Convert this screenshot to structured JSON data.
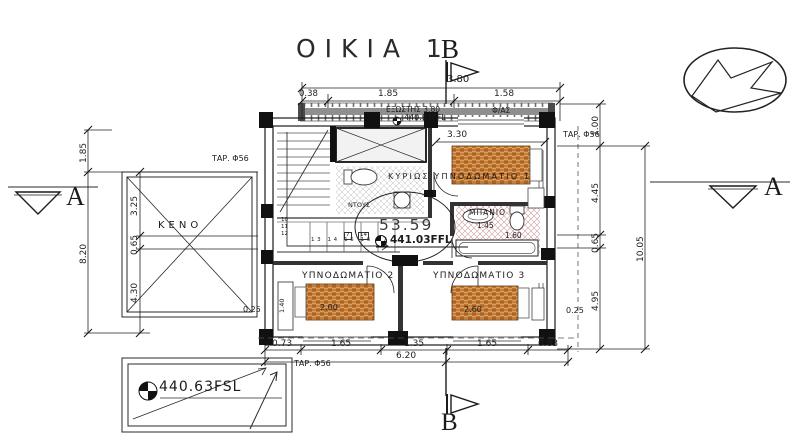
{
  "title": "ΟΙΚΙΑ 1",
  "sections": {
    "top": "B",
    "bottom": "B",
    "left": "A",
    "right": "A"
  },
  "icons": {
    "north": "north-arrow-icon",
    "level_marker": "level-marker-icon",
    "section_triangle": "section-arrow-icon"
  },
  "levels": {
    "floor_area": "53.59",
    "floor_level": "441.03FFL",
    "balcony_level": "440.93FFL",
    "ground_level": "440.63FSL"
  },
  "rooms": {
    "master_bedroom": "ΚΥΡΙΩΣ ΥΠΝΟΔΩΜΑΤΙΟ 1",
    "bedroom2": "ΥΠΝΟΔΩΜΑΤΙΟ 2",
    "bedroom3": "ΥΠΝΟΔΩΜΑΤΙΟ 3",
    "bathroom": "ΜΠΑΝΙΟ",
    "shower": "ΝΤΟΥΣ",
    "void": "ΚΕΝΟ",
    "balcony": "ΕΞΩΣΤΗΣ 3.80",
    "balcony_note": "Φ/ΑΣ"
  },
  "drainpipes": {
    "left": "ΤΑΡ. Φ56",
    "right": "ΤΑΡ. Φ56",
    "bottom": "ΤΑΡ. Φ56"
  },
  "dims": {
    "top_total": "3.80",
    "top": [
      "0.38",
      "1.85",
      "1.58"
    ],
    "left_outer": [
      "1.85",
      "8.20"
    ],
    "left_inner": [
      "3.25",
      "0.65",
      "4.30"
    ],
    "right": [
      "1.00",
      "4.45",
      "0.65",
      "4.95"
    ],
    "right_total": "10.05",
    "bottom": [
      "0.73",
      "1.65",
      "1.35",
      "1.65",
      "0.83"
    ],
    "bottom_total": "6.20",
    "master_width": "3.30",
    "tub": "1.60",
    "bath": "1.45",
    "bed2": "2.00",
    "bed3": "2.60",
    "wardrobe": "1.40",
    "wall_left": "0.25",
    "wall_right": "0.25"
  },
  "stairs": {
    "upper": [
      "10",
      "11",
      "12"
    ],
    "lower": "13 14 15 16 17",
    "tags": [
      "7",
      "14"
    ]
  },
  "colors": {
    "line": "#2b2b2b",
    "bed_base": "#dd9f5f",
    "bed_dark": "#c2742a",
    "railing": "#8f8f8f",
    "bath_hatch": "#cf9d9d"
  }
}
